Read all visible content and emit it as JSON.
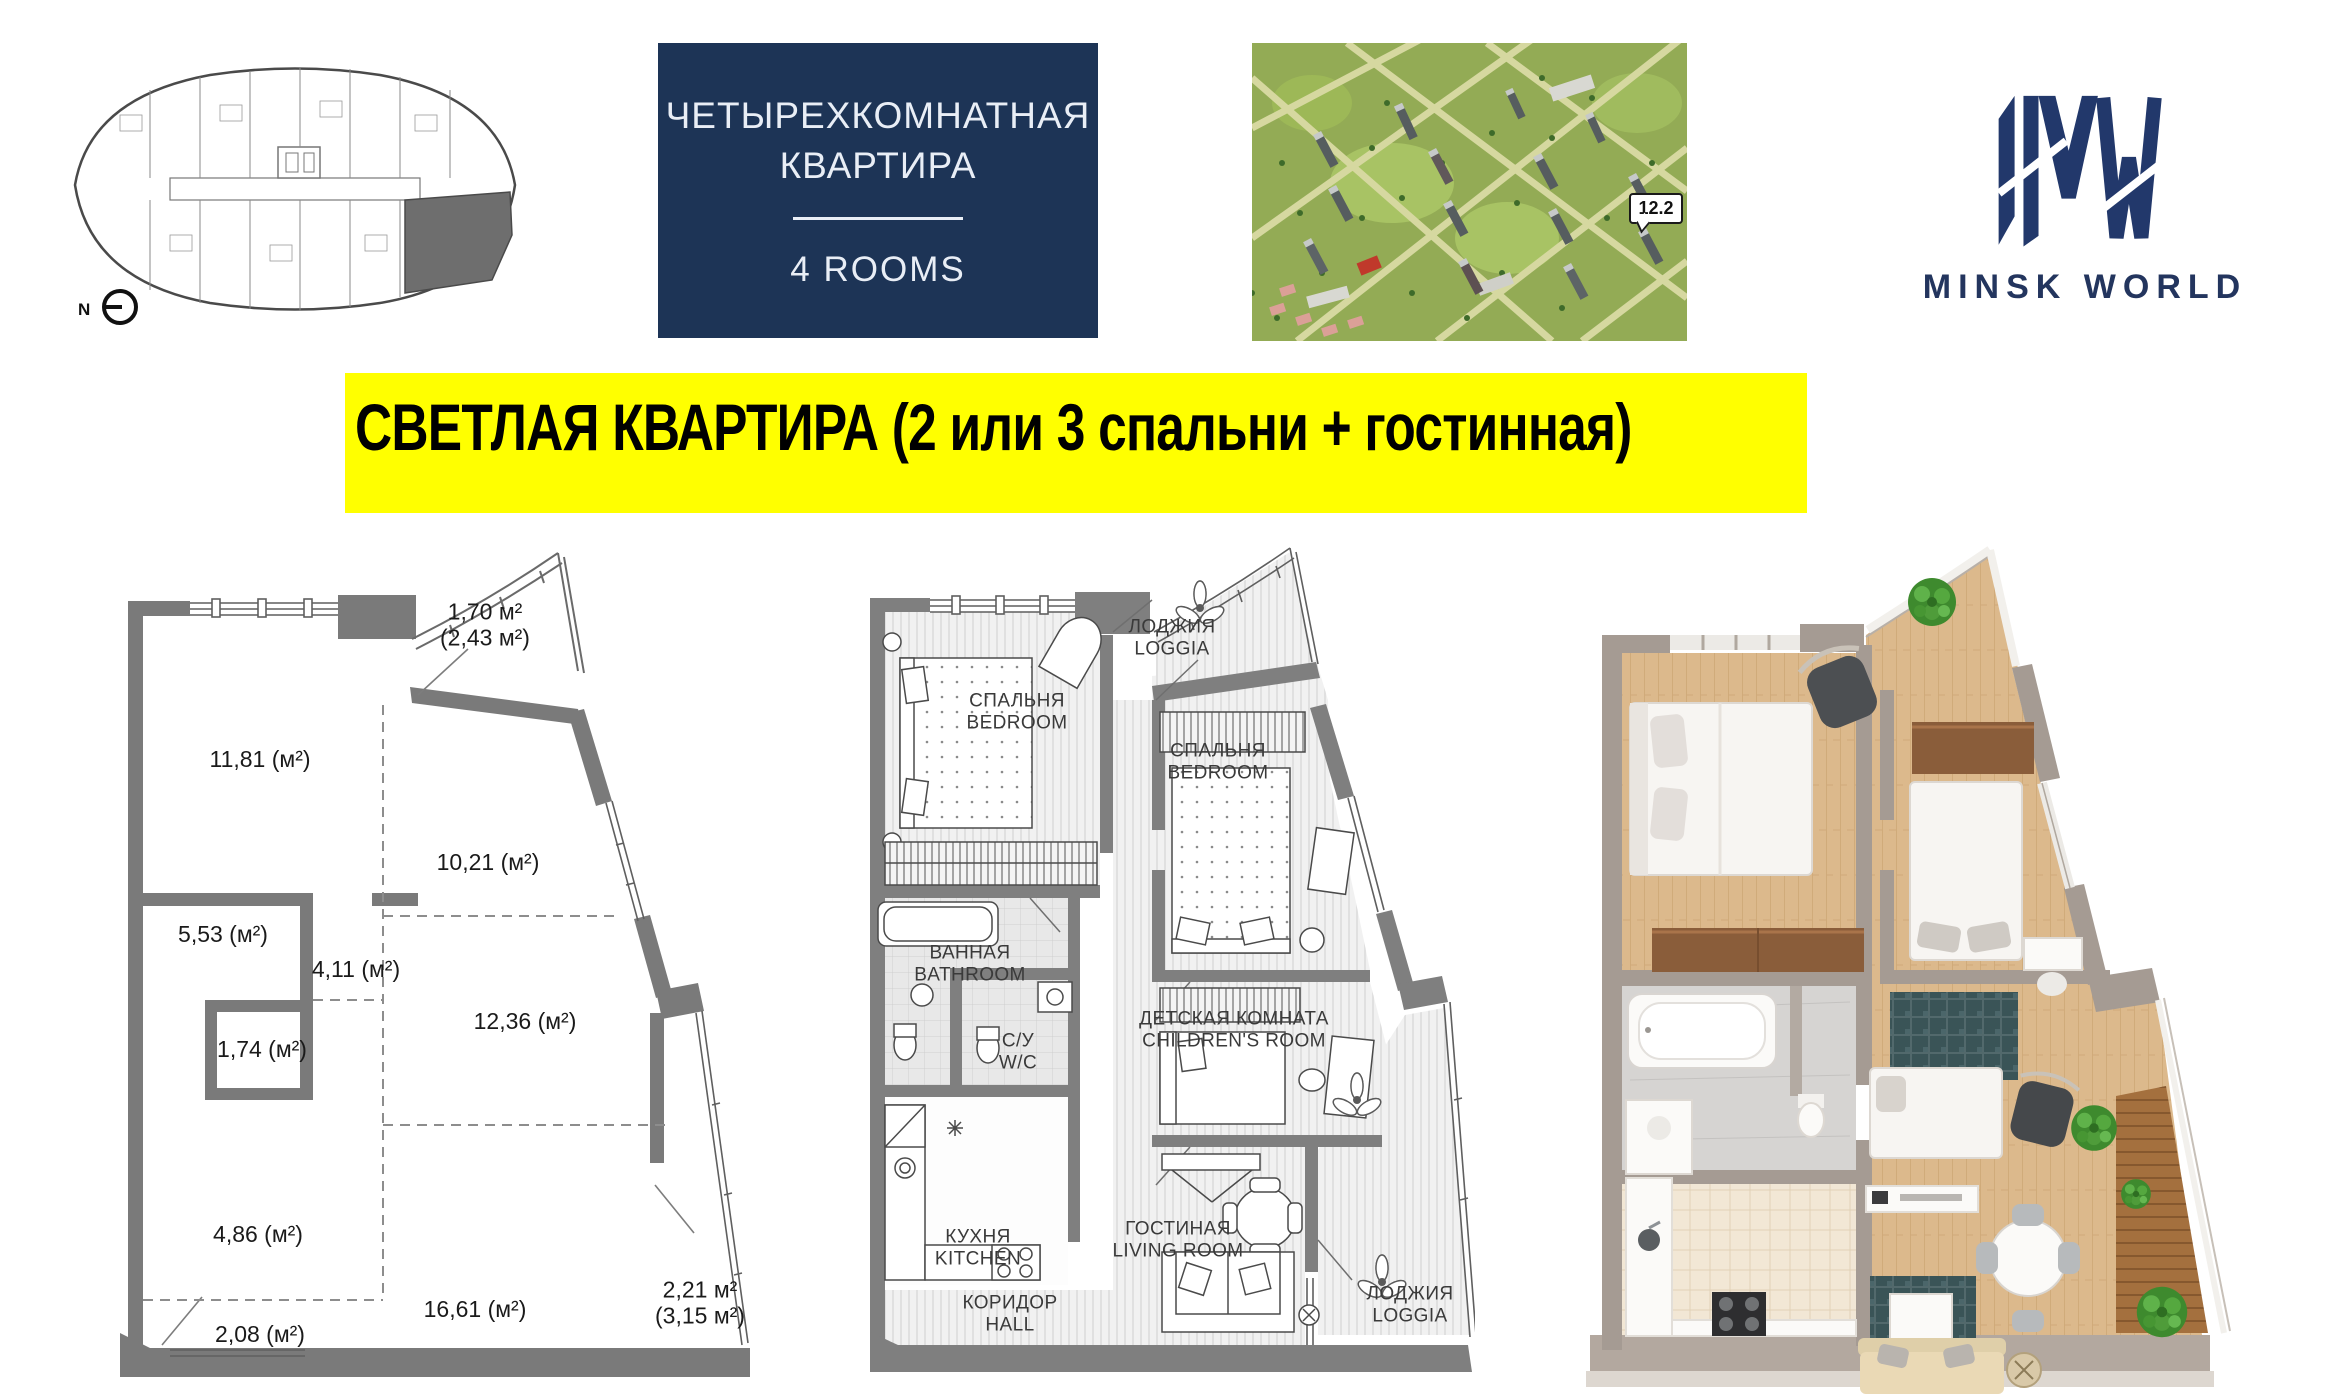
{
  "header": {
    "floor_plate": {
      "north_label": "N"
    },
    "type_card": {
      "line1": "ЧЕТЫРЕХКОМНАТНАЯ",
      "line2": "КВАРТИРА",
      "rooms_label": "4 ROOMS"
    },
    "aerial": {
      "building_tag": "12.2"
    },
    "logo": {
      "text": "MINSK WORLD"
    }
  },
  "banner": {
    "text": "СВЕТЛАЯ КВАРТИРА (2 или 3 спальни + гостинная)"
  },
  "dimension_plan": {
    "areas": [
      {
        "id": "loggia-top",
        "line1": "1,70 м²",
        "line2": "(2,43 м²)"
      },
      {
        "id": "room-11-81",
        "label": "11,81 (м²)"
      },
      {
        "id": "room-10-21",
        "label": "10,21 (м²)"
      },
      {
        "id": "room-5-53",
        "label": "5,53 (м²)"
      },
      {
        "id": "room-4-11",
        "label": "4,11 (м²)"
      },
      {
        "id": "room-1-74",
        "label": "1,74 (м²)"
      },
      {
        "id": "room-12-36",
        "label": "12,36 (м²)"
      },
      {
        "id": "room-4-86",
        "label": "4,86 (м²)"
      },
      {
        "id": "room-16-61",
        "label": "16,61 (м²)"
      },
      {
        "id": "room-2-08",
        "label": "2,08 (м²)"
      },
      {
        "id": "loggia-bottom",
        "line1": "2,21 м²",
        "line2": "(3,15 м²)"
      }
    ]
  },
  "furnished_plan": {
    "rooms": [
      {
        "id": "loggia-top",
        "ru": "ЛОДЖИЯ",
        "en": "LOGGIA"
      },
      {
        "id": "bedroom-1",
        "ru": "СПАЛЬНЯ",
        "en": "BEDROOM"
      },
      {
        "id": "bedroom-2",
        "ru": "СПАЛЬНЯ",
        "en": "BEDROOM"
      },
      {
        "id": "bathroom",
        "ru": "ВАННАЯ",
        "en": "BATHROOM"
      },
      {
        "id": "wc",
        "ru": "С/У",
        "en": "W/C"
      },
      {
        "id": "children-room",
        "ru": "ДЕТСКАЯ КОМНАТА",
        "en": "CHILDREN'S ROOM"
      },
      {
        "id": "kitchen",
        "ru": "КУХНЯ",
        "en": "KITCHEN"
      },
      {
        "id": "living-room",
        "ru": "ГОСТИНАЯ",
        "en": "LIVING ROOM"
      },
      {
        "id": "hall",
        "ru": "КОРИДОР",
        "en": "HALL"
      },
      {
        "id": "loggia-bottom",
        "ru": "ЛОДЖИЯ",
        "en": "LOGGIA"
      }
    ]
  },
  "colors": {
    "banner_bg": "#ffff00",
    "banner_text": "#000000",
    "card_bg": "#1d3456",
    "card_text": "#e9eef6",
    "logo_navy": "#23355e",
    "plan_wall_gray": "#7a7a7a",
    "highlight_unit_gray": "#6e6e6e",
    "wood_floor": "#dbb88c",
    "site_green": "#93ab55"
  }
}
